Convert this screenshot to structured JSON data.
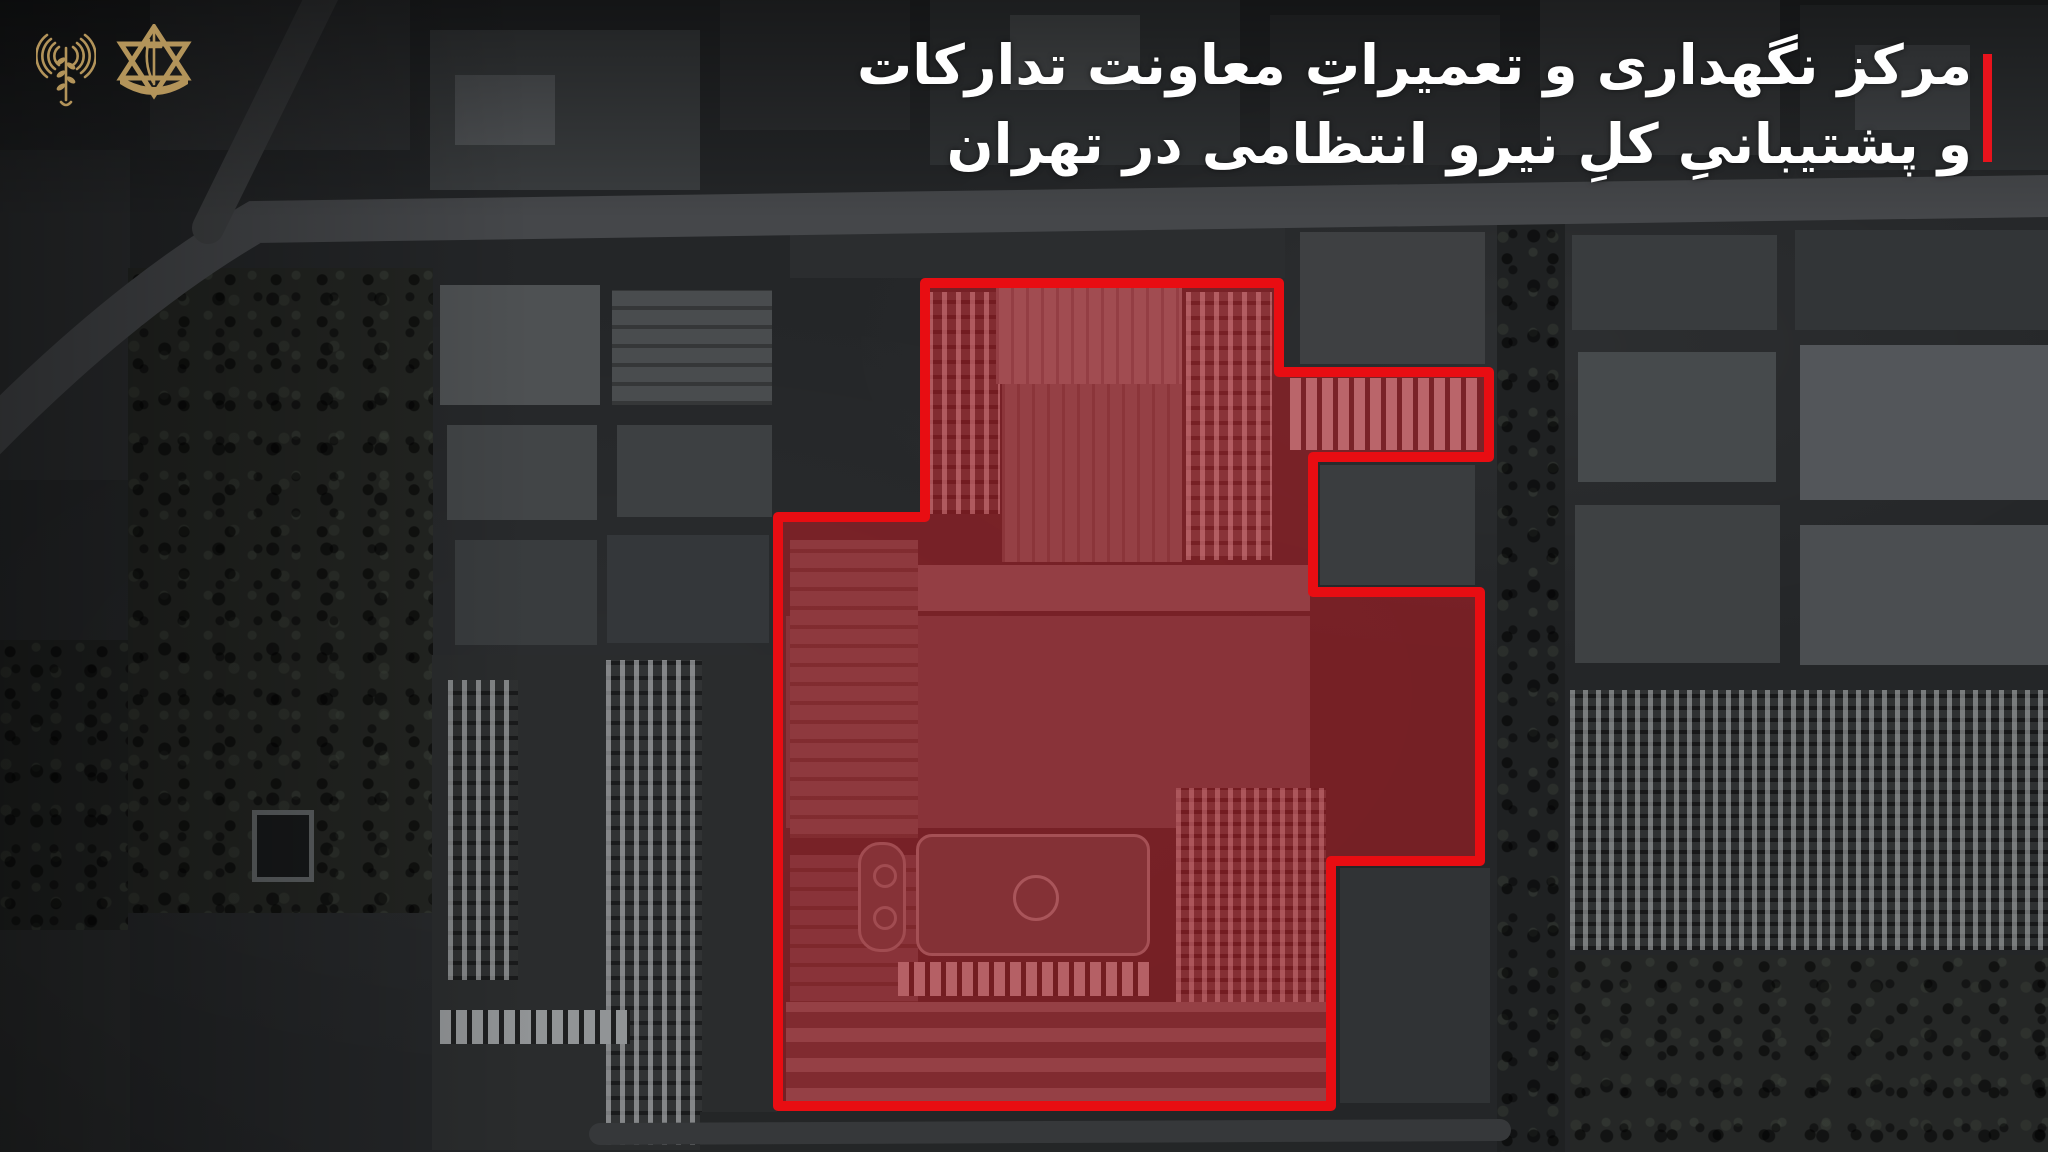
{
  "header": {
    "title_line1": "مرکز نگهداری و تعمیراتِ معاونت تدارکات",
    "title_line2": "و پشتیبانیِ کلِ نیرو انتظامی در تهران",
    "accent_color": "#e8131c",
    "text_color": "#ffffff"
  },
  "logos": {
    "left_name": "idf-spokesperson-radio-waves-emblem",
    "right_name": "idf-star-of-david-emblem",
    "gold_color": "#b3945a"
  },
  "map": {
    "base_color": "#242628",
    "roads": [
      {
        "name": "main-road-west-curve",
        "d": "M -30 455 Q 120 300 255 222 L 2048 196",
        "color": "#45474a",
        "width": 42
      },
      {
        "name": "north-branch-road",
        "d": "M 208 228 L 330 -20",
        "color": "#3f4143",
        "width": 32
      },
      {
        "name": "south-service-road",
        "d": "M 600 1134 L 1500 1130",
        "color": "#36383a",
        "width": 22
      }
    ],
    "overlay": {
      "name": "target-compound-outline",
      "fill": "rgba(230,25,33,0.42)",
      "stroke": "#e80d12",
      "stroke_width": 10,
      "polygon_points": [
        [
          925,
          283
        ],
        [
          1279,
          283
        ],
        [
          1279,
          372
        ],
        [
          1489,
          372
        ],
        [
          1489,
          457
        ],
        [
          1313,
          457
        ],
        [
          1313,
          592
        ],
        [
          1480,
          592
        ],
        [
          1480,
          861
        ],
        [
          1331,
          861
        ],
        [
          1331,
          1106
        ],
        [
          778,
          1106
        ],
        [
          778,
          517
        ],
        [
          925,
          517
        ]
      ]
    },
    "features": [
      {
        "n": "city-block",
        "t": "block",
        "x": 150,
        "y": 0,
        "w": 260,
        "h": 150,
        "c": "#2f3133"
      },
      {
        "n": "city-block",
        "t": "block",
        "x": 430,
        "y": 30,
        "w": 270,
        "h": 160,
        "c": "#3b3e40"
      },
      {
        "n": "warehouse-roof",
        "t": "block",
        "x": 455,
        "y": 75,
        "w": 100,
        "h": 70,
        "c": "#54575a"
      },
      {
        "n": "city-block",
        "t": "block",
        "x": 720,
        "y": 0,
        "w": 190,
        "h": 130,
        "c": "#2c2e30"
      },
      {
        "n": "city-block",
        "t": "block",
        "x": 930,
        "y": 0,
        "w": 310,
        "h": 165,
        "c": "#323537"
      },
      {
        "n": "warehouse-roof",
        "t": "block",
        "x": 1010,
        "y": 15,
        "w": 130,
        "h": 75,
        "c": "#4b4e50"
      },
      {
        "n": "city-block",
        "t": "block",
        "x": 1270,
        "y": 15,
        "w": 230,
        "h": 150,
        "c": "#2e3032"
      },
      {
        "n": "city-block",
        "t": "block",
        "x": 1540,
        "y": 0,
        "w": 240,
        "h": 155,
        "c": "#353739"
      },
      {
        "n": "city-block",
        "t": "block",
        "x": 1800,
        "y": 5,
        "w": 248,
        "h": 165,
        "c": "#2f3234"
      },
      {
        "n": "warehouse-roof",
        "t": "block",
        "x": 1855,
        "y": 45,
        "w": 115,
        "h": 85,
        "c": "#44474a"
      },
      {
        "n": "city-block",
        "t": "block",
        "x": 0,
        "y": 150,
        "w": 130,
        "h": 330,
        "c": "#2b2d2f"
      },
      {
        "n": "tree-park",
        "t": "trees",
        "x": 128,
        "y": 268,
        "w": 305,
        "h": 645,
        "c": "#232522"
      },
      {
        "n": "pool",
        "t": "pool",
        "x": 252,
        "y": 810,
        "w": 62,
        "h": 72,
        "c": "#17191a"
      },
      {
        "n": "industrial-roof",
        "t": "block",
        "x": 440,
        "y": 285,
        "w": 160,
        "h": 120,
        "c": "#4e5153"
      },
      {
        "n": "industrial-roof",
        "t": "block",
        "x": 447,
        "y": 425,
        "w": 150,
        "h": 95,
        "c": "#424547"
      },
      {
        "n": "industrial-roof",
        "t": "block",
        "x": 455,
        "y": 540,
        "w": 142,
        "h": 105,
        "c": "#393c3e"
      },
      {
        "n": "industrial-roof",
        "t": "ribs-h",
        "x": 612,
        "y": 290,
        "w": 160,
        "h": 115,
        "c": "#494c4e"
      },
      {
        "n": "industrial-roof",
        "t": "block",
        "x": 617,
        "y": 425,
        "w": 155,
        "h": 92,
        "c": "#3d4042"
      },
      {
        "n": "industrial-roof",
        "t": "block",
        "x": 607,
        "y": 535,
        "w": 162,
        "h": 108,
        "c": "#34373a"
      },
      {
        "n": "truck-yard",
        "t": "block",
        "x": 432,
        "y": 655,
        "w": 345,
        "h": 495,
        "c": "#2a2c2d"
      },
      {
        "n": "truck-row",
        "t": "trucks-v",
        "x": 606,
        "y": 660,
        "w": 96,
        "h": 485,
        "c": "#313334"
      },
      {
        "n": "truck-row",
        "t": "trucks-v",
        "x": 448,
        "y": 680,
        "w": 70,
        "h": 300,
        "c": "#2e3031"
      },
      {
        "n": "container-row",
        "t": "trucks-h",
        "x": 440,
        "y": 1010,
        "w": 190,
        "h": 34,
        "c": "#37393b"
      },
      {
        "n": "tree-cluster",
        "t": "trees",
        "x": 0,
        "y": 640,
        "w": 128,
        "h": 290,
        "c": "#202221"
      },
      {
        "n": "city-block",
        "t": "block",
        "x": 0,
        "y": 930,
        "w": 130,
        "h": 222,
        "c": "#282a2b"
      },
      {
        "n": "tree-lined-street",
        "t": "trees",
        "x": 1497,
        "y": 205,
        "w": 68,
        "h": 947,
        "c": "#1f2122"
      },
      {
        "n": "city-block",
        "t": "block",
        "x": 1572,
        "y": 235,
        "w": 205,
        "h": 95,
        "c": "#393c3e"
      },
      {
        "n": "city-block",
        "t": "block",
        "x": 1795,
        "y": 230,
        "w": 253,
        "h": 100,
        "c": "#323537"
      },
      {
        "n": "warehouse-roof",
        "t": "block",
        "x": 1800,
        "y": 345,
        "w": 248,
        "h": 155,
        "c": "#53565a"
      },
      {
        "n": "warehouse-roof",
        "t": "block",
        "x": 1578,
        "y": 352,
        "w": 198,
        "h": 130,
        "c": "#464a4c"
      },
      {
        "n": "warehouse-roof",
        "t": "block",
        "x": 1800,
        "y": 525,
        "w": 248,
        "h": 140,
        "c": "#4b4e51"
      },
      {
        "n": "industrial-roof",
        "t": "block",
        "x": 1575,
        "y": 505,
        "w": 205,
        "h": 158,
        "c": "#3e4143"
      },
      {
        "n": "residential-grid",
        "t": "trucks-grid",
        "x": 1570,
        "y": 690,
        "w": 478,
        "h": 260,
        "c": "#2f3132"
      },
      {
        "n": "tree-block",
        "t": "trees",
        "x": 1570,
        "y": 955,
        "w": 478,
        "h": 197,
        "c": "#252726"
      },
      {
        "n": "city-block",
        "t": "block",
        "x": 790,
        "y": 228,
        "w": 495,
        "h": 50,
        "c": "#2b2d2f"
      },
      {
        "n": "building",
        "t": "block",
        "x": 1300,
        "y": 232,
        "w": 185,
        "h": 132,
        "c": "#3e4042"
      },
      {
        "n": "truck-clutter",
        "t": "trucks-v",
        "x": 928,
        "y": 292,
        "w": 72,
        "h": 222,
        "c": "#393b3d"
      },
      {
        "n": "warehouse-roof-large",
        "t": "ribs-v",
        "x": 996,
        "y": 288,
        "w": 186,
        "h": 96,
        "c": "#6f7274"
      },
      {
        "n": "warehouse-ribbed",
        "t": "ribs-v",
        "x": 1002,
        "y": 384,
        "w": 180,
        "h": 178,
        "c": "#5b5e60"
      },
      {
        "n": "truck-rows",
        "t": "trucks-v",
        "x": 1186,
        "y": 292,
        "w": 86,
        "h": 268,
        "c": "#454749"
      },
      {
        "n": "truck-rows-arm",
        "t": "trucks-h",
        "x": 1290,
        "y": 378,
        "w": 192,
        "h": 72,
        "c": "#4e5052"
      },
      {
        "n": "notch-building",
        "t": "block",
        "x": 1320,
        "y": 465,
        "w": 155,
        "h": 120,
        "c": "#3a3d3f"
      },
      {
        "n": "long-building",
        "t": "block",
        "x": 880,
        "y": 565,
        "w": 430,
        "h": 46,
        "c": "#585b5d"
      },
      {
        "n": "inner-yard",
        "t": "block",
        "x": 786,
        "y": 616,
        "w": 524,
        "h": 212,
        "c": "#46484a"
      },
      {
        "n": "inner-buildings",
        "t": "ribs-h",
        "x": 790,
        "y": 540,
        "w": 128,
        "h": 298,
        "c": "#4e5153"
      },
      {
        "n": "inner-buildings",
        "t": "ribs-h",
        "x": 790,
        "y": 855,
        "w": 128,
        "h": 245,
        "c": "#45484a"
      },
      {
        "n": "soccer-field",
        "t": "field",
        "x": 916,
        "y": 834,
        "w": 234,
        "h": 122,
        "c": "#3d4446"
      },
      {
        "n": "mini-track",
        "t": "track",
        "x": 858,
        "y": 842,
        "w": 48,
        "h": 110,
        "c": "#414547"
      },
      {
        "n": "container-row",
        "t": "trucks-h",
        "x": 898,
        "y": 962,
        "w": 252,
        "h": 34,
        "c": "#3a3c3e"
      },
      {
        "n": "truck-grid",
        "t": "trucks-grid",
        "x": 1176,
        "y": 788,
        "w": 150,
        "h": 302,
        "c": "#3e4042"
      },
      {
        "n": "striped-roofs",
        "t": "stripes-h",
        "x": 786,
        "y": 1002,
        "w": 546,
        "h": 100,
        "c": "#44474a"
      },
      {
        "n": "notch-building",
        "t": "block",
        "x": 1340,
        "y": 868,
        "w": 150,
        "h": 235,
        "c": "#303335"
      },
      {
        "n": "city-block",
        "t": "block",
        "x": 700,
        "y": 1112,
        "w": 640,
        "h": 40,
        "c": "#242627"
      }
    ]
  }
}
